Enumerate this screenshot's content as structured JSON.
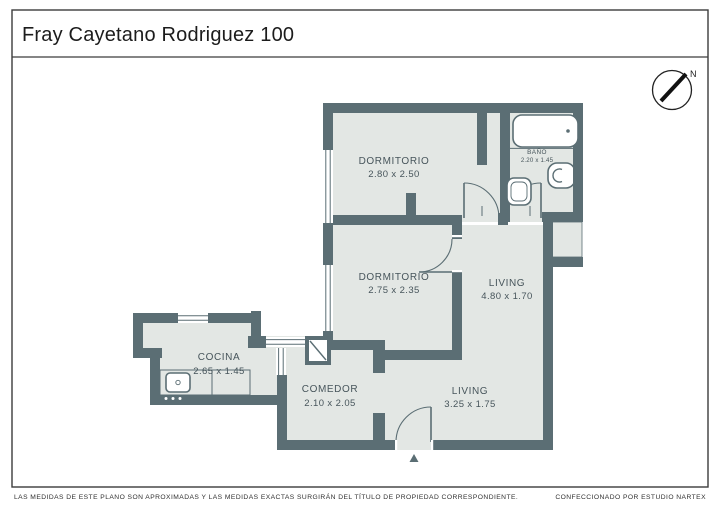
{
  "page": {
    "title": "Fray Cayetano Rodriguez 100"
  },
  "compass": {
    "label": "N"
  },
  "rooms": [
    {
      "id": "dormitorio-1",
      "name": "DORMITORIO",
      "dims": "2.80 x 2.50"
    },
    {
      "id": "dormitorio-2",
      "name": "DORMITORIO",
      "dims": "2.75 x 2.35"
    },
    {
      "id": "living-1",
      "name": "LIVING",
      "dims": "4.80 x 1.70"
    },
    {
      "id": "bano",
      "name": "BAÑO",
      "dims": "2.20 x 1.45"
    },
    {
      "id": "cocina",
      "name": "COCINA",
      "dims": "2.65 x 1.45"
    },
    {
      "id": "comedor",
      "name": "COMEDOR",
      "dims": "2.10 x 2.05"
    },
    {
      "id": "living-2",
      "name": "LIVING",
      "dims": "3.25 x 1.75"
    }
  ],
  "footer": {
    "disclaimer": "LAS MEDIDAS  DE ESTE PLANO SON APROXIMADAS Y LAS MEDIDAS EXACTAS SURGIRÁN DEL TÍTULO DE PROPIEDAD CORRESPONDIENTE.",
    "credit": "CONFECCIONADO POR ESTUDIO NARTEX"
  },
  "colors": {
    "wall": "#5b6e74",
    "floor": "#e3e7e4",
    "frame": "#3c3c3c"
  }
}
